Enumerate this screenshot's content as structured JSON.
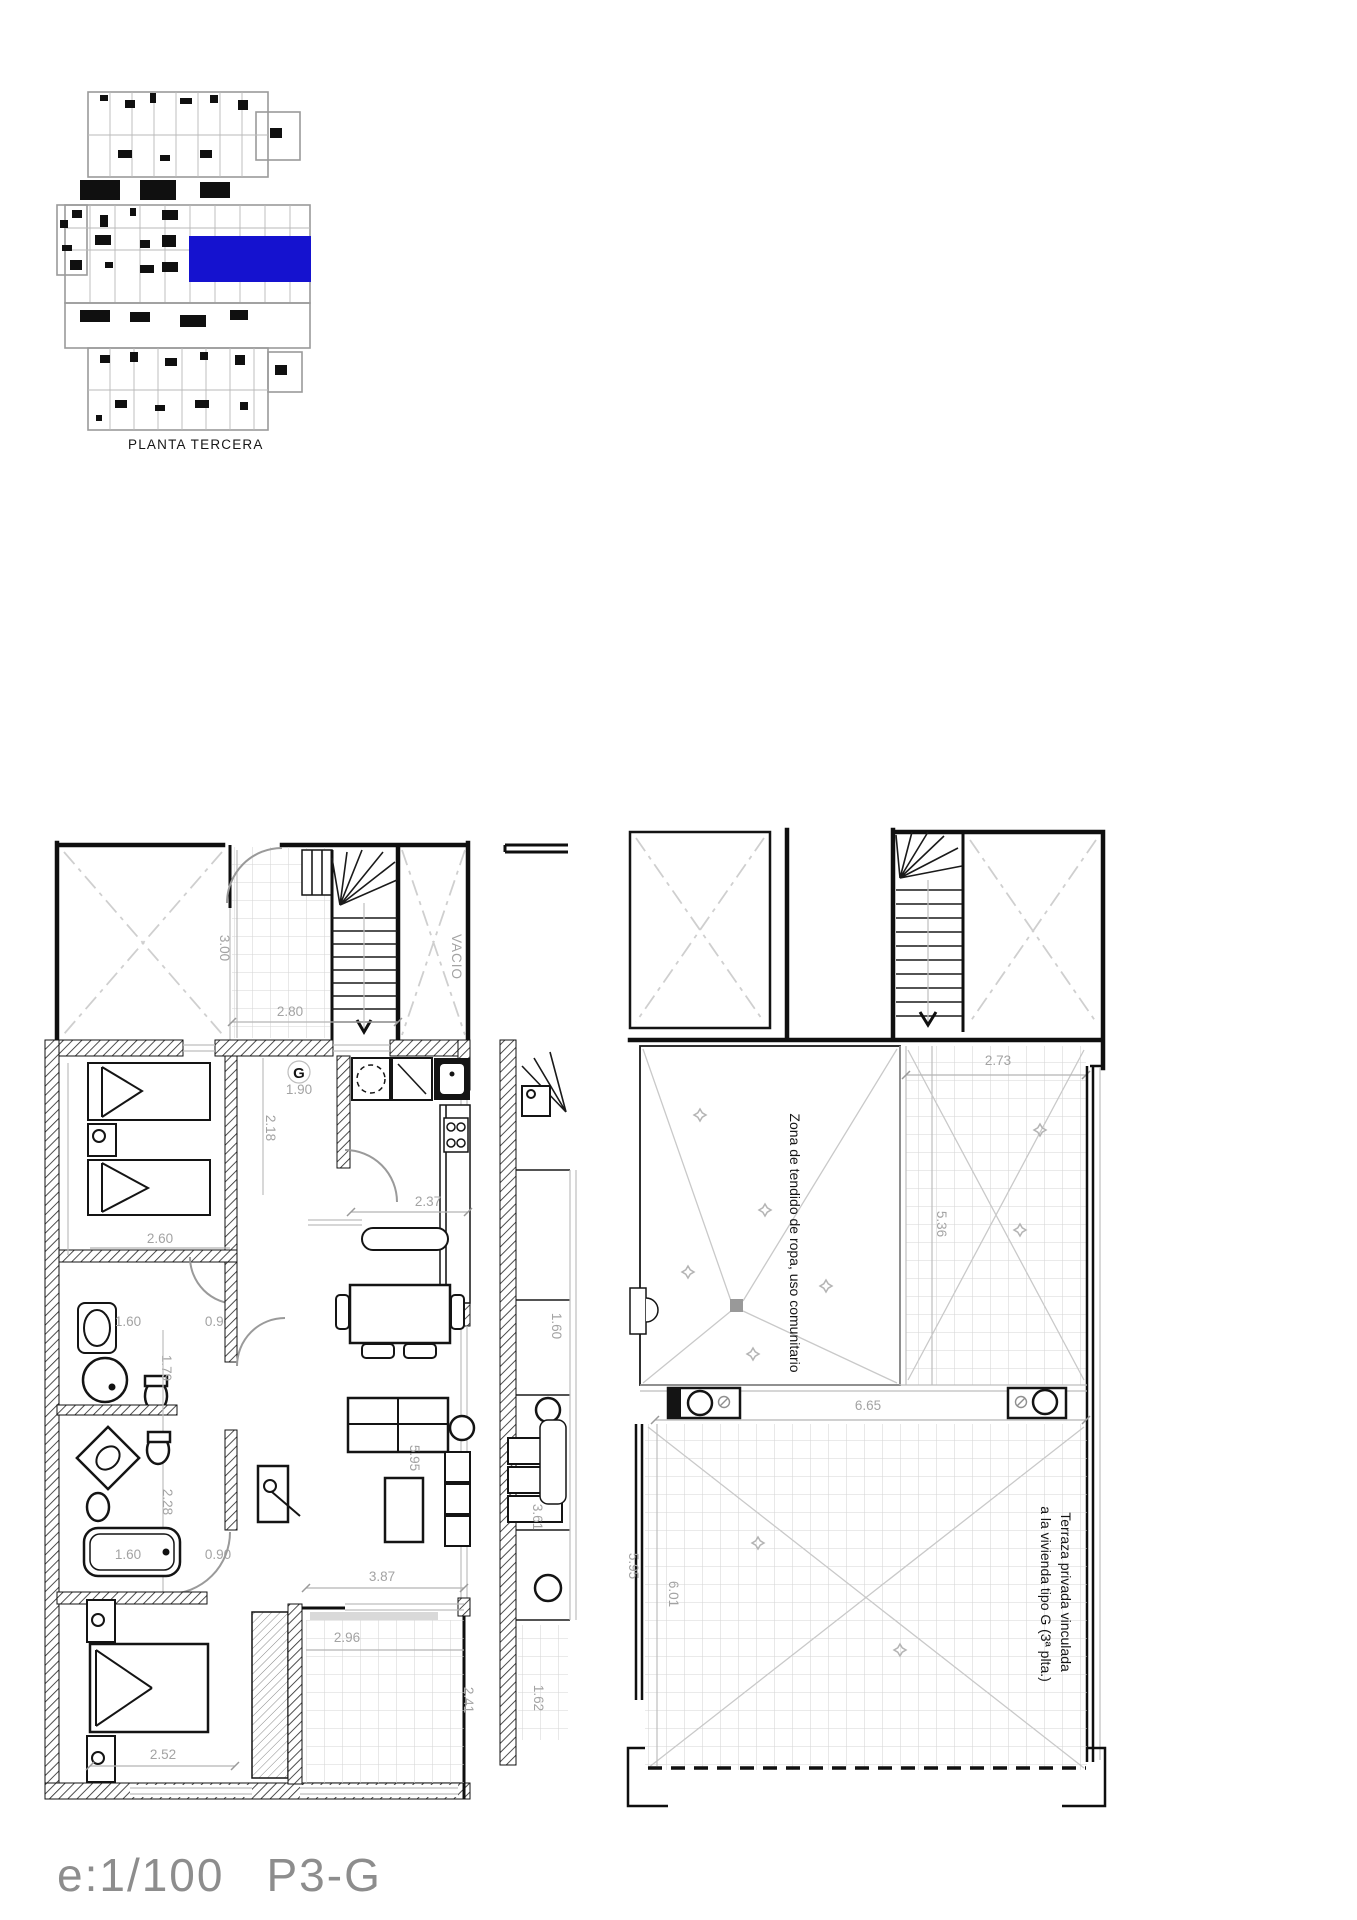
{
  "page": {
    "background": "#ffffff"
  },
  "key_plan": {
    "caption": "PLANTA TERCERA",
    "highlight_color": "#1512cf"
  },
  "footer": {
    "scale": "e:1/100",
    "sheet_code": "P3-G"
  },
  "left_plan": {
    "labels": {
      "void": "VACIO",
      "unit_letter": "G"
    },
    "dims": {
      "entry_width": "1.90",
      "stair_hall_depth": "3.00",
      "stair_hall_width": "2.80",
      "hall_length": "2.18",
      "bedroom1_width": "2.60",
      "kitchen_width": "2.37",
      "bath1_width": "1.60",
      "bath1_door": "0.90",
      "bath1_length": "1.79",
      "bath2_length": "2.28",
      "bathtub_length": "1.60",
      "bath2_door": "0.90",
      "living_width": "3.87",
      "living_length": "5.95",
      "bedroom2_width": "2.52",
      "terrace_width": "2.96",
      "terrace_depth": "2.41"
    },
    "neighbor_dims": {
      "gallery_width": "1.60",
      "room_length": "3.61",
      "terrace_depth": "1.62"
    }
  },
  "right_plan": {
    "labels": {
      "drying_zone": "Zona de tendido de ropa, uso comunitario",
      "private_terrace_line1": "Terraza privada vinculada",
      "private_terrace_line2": "a la vivienda tipo G (3ª plta.)"
    },
    "dims": {
      "upper_terrace_width": "2.73",
      "upper_terrace_length": "5.36",
      "terrace_width": "6.65",
      "terrace_length_a": "5.95",
      "terrace_length_b": "6.01"
    }
  }
}
